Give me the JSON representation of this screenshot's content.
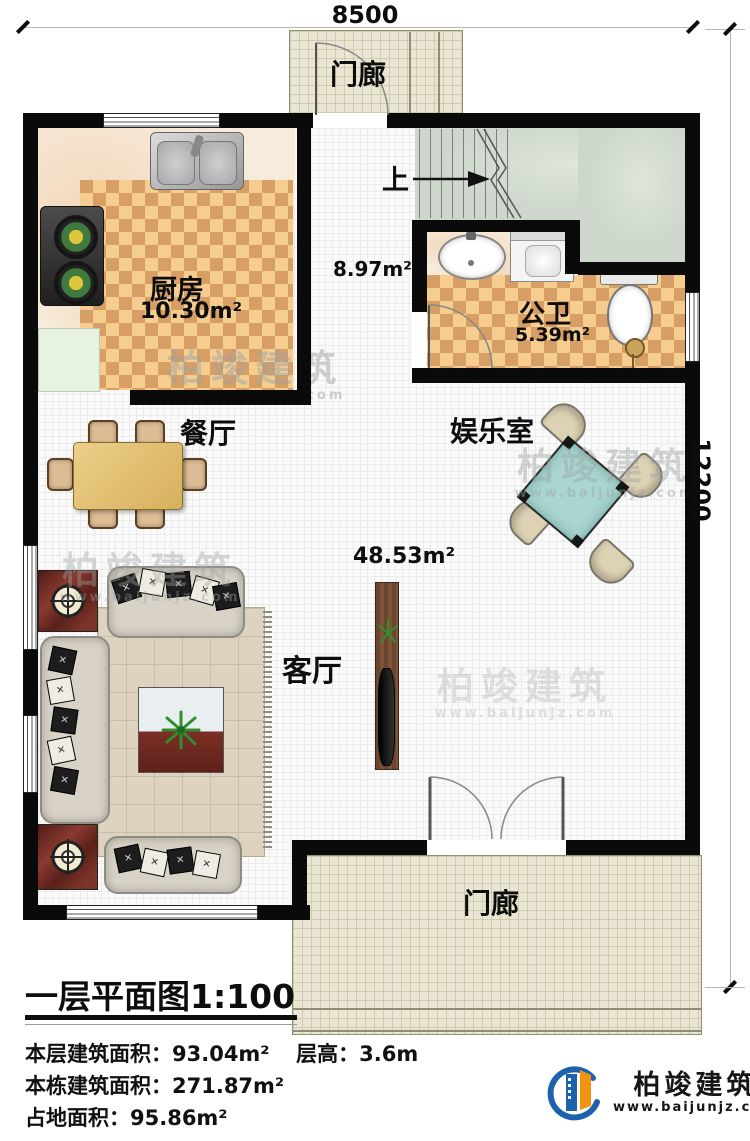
{
  "dimensions": {
    "width": "8500",
    "height": "12200"
  },
  "rooms": {
    "porch_top": {
      "label": "门廊"
    },
    "porch_bottom": {
      "label": "门廊"
    },
    "kitchen": {
      "label": "厨房",
      "area": "10.30m²"
    },
    "hallway": {
      "area": "8.97m²",
      "stairs_up": "上"
    },
    "bathroom": {
      "label": "公卫",
      "area": "5.39m²"
    },
    "dining": {
      "label": "餐厅"
    },
    "entertainment": {
      "label": "娱乐室"
    },
    "living": {
      "label": "客厅",
      "area": "48.53m²"
    }
  },
  "footer": {
    "title": "一层平面图",
    "scale": "1:100",
    "area_floor_label": "本层建筑面积：",
    "area_floor_value": "93.04m²",
    "floor_height_label": "层高：",
    "floor_height_value": "3.6m",
    "area_building_label": "本栋建筑面积：",
    "area_building_value": "271.87m²",
    "area_land_label": "占地面积：",
    "area_land_value": "95.86m²"
  },
  "branding": {
    "company": "柏竣建筑",
    "website": "www.baijunjz.com"
  },
  "colors": {
    "wall": "#0a0a0a",
    "checker_light": "#f5cd8e",
    "checker_dark": "#d79e66",
    "porch_floor": "#eae6d3",
    "stairs_floor": "#cdd7cb",
    "logo_blue": "#1e62ae",
    "logo_orange": "#f0930f"
  }
}
